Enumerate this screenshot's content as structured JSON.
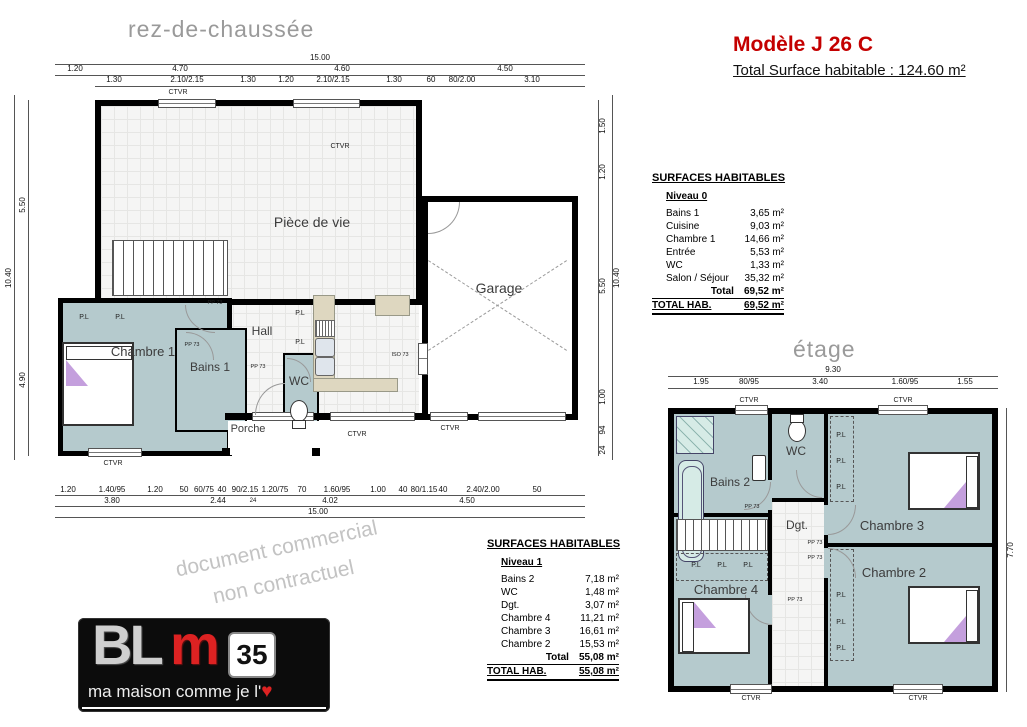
{
  "header": {
    "model": "Modèle  J 26 C",
    "total": "Total Surface habitable : 124.60 m²"
  },
  "rdc": {
    "title": "rez-de-chaussée",
    "rooms": {
      "piece_de_vie": "Pièce de vie",
      "garage": "Garage",
      "chambre1": "Chambre 1",
      "bains1": "Bains 1",
      "hall": "Hall",
      "wc": "WC",
      "porche": "Porche"
    },
    "tags": {
      "pl": "P.L",
      "ctvr": "CTVR",
      "pp73": "PP 73",
      "iso73": "ISO 73"
    },
    "dims": {
      "top_total": "15.00",
      "top_row": [
        "1.20",
        "4.70",
        "4.60",
        "4.50"
      ],
      "top_sub": [
        "1.30",
        "2.10/2.15",
        "1.30",
        "1.20",
        "2.10/2.15",
        "1.30",
        "60",
        "80/2.00",
        "3.10"
      ],
      "bottom_sub": [
        "1.20",
        "1.40/95",
        "1.20",
        "50",
        "60/75",
        "40",
        "90/2.15",
        "1.20/75",
        "70",
        "1.60/95",
        "1.00",
        "40",
        "80/1.15",
        "40",
        "2.40/2.00",
        "50"
      ],
      "bottom_row": [
        "3.80",
        "2.44",
        "24",
        "4.02",
        "4.50"
      ],
      "bottom_total": "15.00",
      "left": [
        "5.50",
        "10.40",
        "4.90"
      ],
      "right": [
        "1.50",
        "1.20",
        "5.50",
        "10.40",
        "1.00",
        "94",
        "24"
      ]
    }
  },
  "etage": {
    "title": "étage",
    "rooms": {
      "bains2": "Bains 2",
      "wc": "WC",
      "dgt": "Dgt.",
      "chambre3": "Chambre 3",
      "chambre2": "Chambre 2",
      "chambre4": "Chambre 4"
    },
    "dims": {
      "top_total": "9.30",
      "top_row": [
        "1.95",
        "80/95",
        "3.40",
        "1.60/95",
        "1.55"
      ],
      "right": "7.70"
    }
  },
  "tables": {
    "heading": "SURFACES HABITABLES",
    "niveau0": {
      "level": "Niveau 0",
      "rows": [
        {
          "name": "Bains 1",
          "value": "3,65 m²"
        },
        {
          "name": "Cuisine",
          "value": "9,03 m²"
        },
        {
          "name": "Chambre 1",
          "value": "14,66 m²"
        },
        {
          "name": "Entrée",
          "value": "5,53 m²"
        },
        {
          "name": "WC",
          "value": "1,33 m²"
        },
        {
          "name": "Salon / Séjour",
          "value": "35,32 m²"
        }
      ],
      "total_label": "Total",
      "total_value": "69,52 m²",
      "grand_label": "TOTAL HAB.",
      "grand_value": "69,52 m²"
    },
    "niveau1": {
      "level": "Niveau 1",
      "rows": [
        {
          "name": "Bains 2",
          "value": "7,18 m²"
        },
        {
          "name": "WC",
          "value": "1,48 m²"
        },
        {
          "name": "Dgt.",
          "value": "3,07 m²"
        },
        {
          "name": "Chambre 4",
          "value": "11,21 m²"
        },
        {
          "name": "Chambre 3",
          "value": "16,61 m²"
        },
        {
          "name": "Chambre 2",
          "value": "15,53 m²"
        }
      ],
      "total_label": "Total",
      "total_value": "55,08 m²",
      "grand_label": "TOTAL HAB.",
      "grand_value": "55,08 m²"
    }
  },
  "watermark": {
    "line1": "document commercial",
    "line2": "non contractuel"
  },
  "logo": {
    "bl": "BL",
    "m": "m",
    "dept": "35",
    "tagline": "ma maison comme je l'",
    "heart": "♥"
  }
}
